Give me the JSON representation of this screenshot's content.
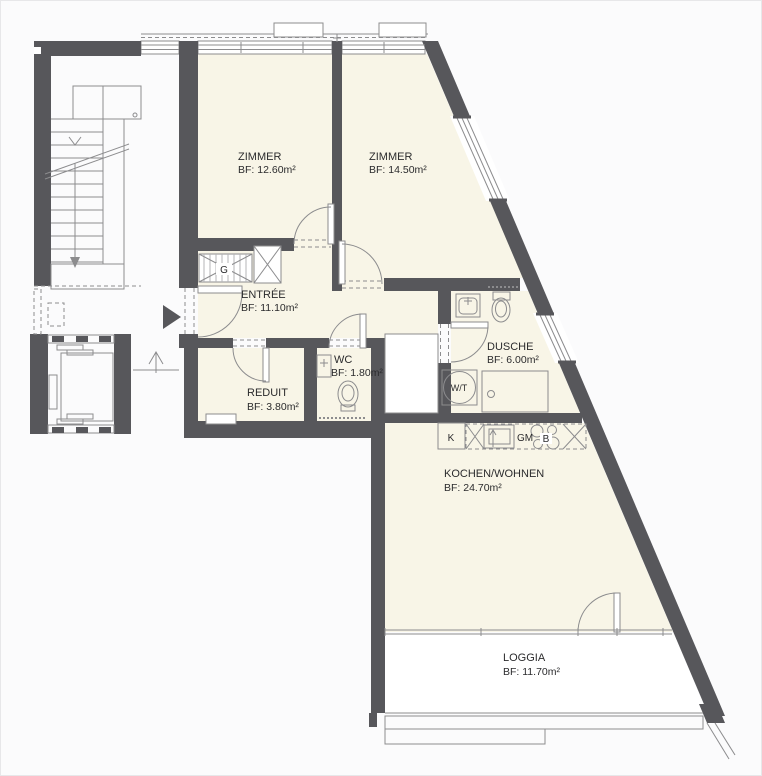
{
  "colors": {
    "wall": "#57575b",
    "thin_line": "#8c8c8e",
    "room_fill": "#f8f5e7",
    "loggia_fill": "#ffffff",
    "text": "#2b2b2d",
    "background": "#fbfbfc"
  },
  "rooms": {
    "zimmer1": {
      "name": "ZIMMER",
      "area": "BF: 12.60m²"
    },
    "zimmer2": {
      "name": "ZIMMER",
      "area": "BF: 14.50m²"
    },
    "entree": {
      "name": "ENTRÉE",
      "area": "BF: 11.10m²"
    },
    "wc": {
      "name": "WC",
      "area": "BF: 1.80m²"
    },
    "reduit": {
      "name": "REDUIT",
      "area": "BF: 3.80m²"
    },
    "dusche": {
      "name": "DUSCHE",
      "area": "BF: 6.00m²"
    },
    "kochen": {
      "name": "KOCHEN/WOHNEN",
      "area": "BF: 24.70m²"
    },
    "loggia": {
      "name": "LOGGIA",
      "area": "BF: 11.70m²"
    }
  },
  "fixtures": {
    "wardrobe_label": "G",
    "washer_dryer_label": "W/T",
    "fridge_label": "K",
    "dishwasher_label": "GM",
    "cooktop_label": "B"
  }
}
